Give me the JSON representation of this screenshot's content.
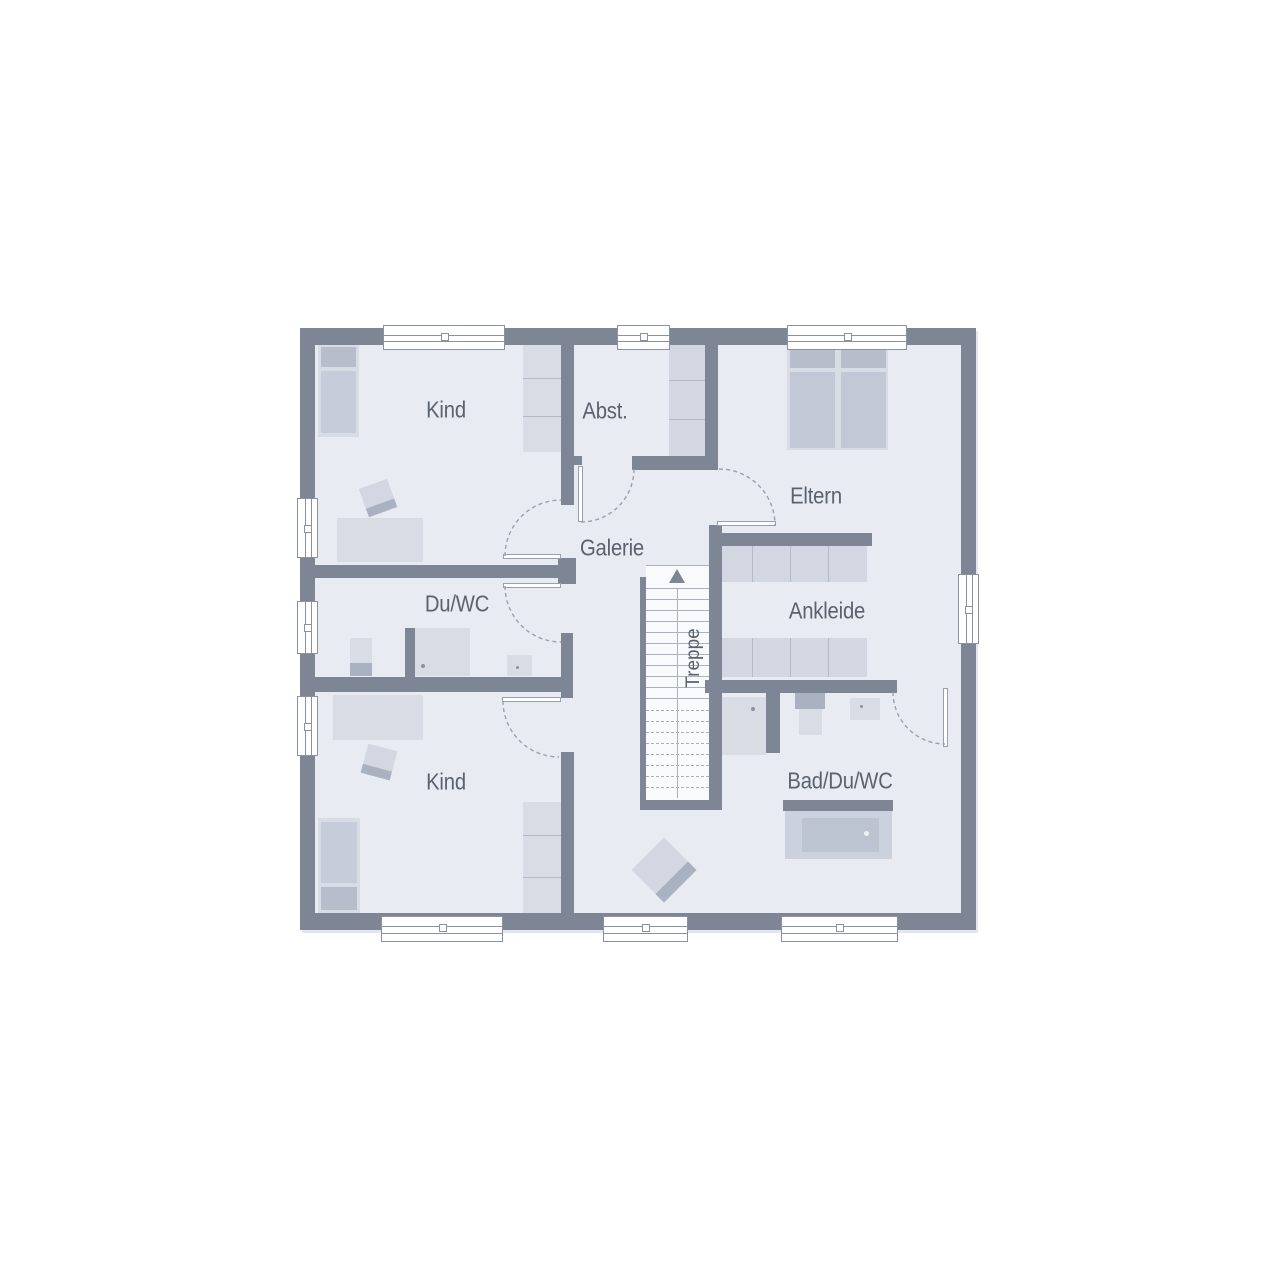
{
  "floorplan": {
    "rooms": [
      {
        "id": "kind-top",
        "label": "Kind"
      },
      {
        "id": "abstellraum",
        "label": "Abst."
      },
      {
        "id": "eltern",
        "label": "Eltern"
      },
      {
        "id": "galerie",
        "label": "Galerie"
      },
      {
        "id": "du-wc",
        "label": "Du/WC"
      },
      {
        "id": "ankleide",
        "label": "Ankleide"
      },
      {
        "id": "kind-bottom",
        "label": "Kind"
      },
      {
        "id": "bad-du-wc",
        "label": "Bad/Du/WC"
      }
    ],
    "stairs": {
      "label": "Treppe",
      "direction": "up"
    },
    "colors": {
      "wall": "#7e8695",
      "room_fill": "#e8ebf1",
      "stairwell_fill": "#f8fafc",
      "furniture_light": "#d8dce5",
      "furniture_medium": "#c6ccd9",
      "furniture_dark": "#aab1c0",
      "pillow": "#b7bdcb",
      "label_text": "#5a626e",
      "background": "#ffffff"
    }
  }
}
